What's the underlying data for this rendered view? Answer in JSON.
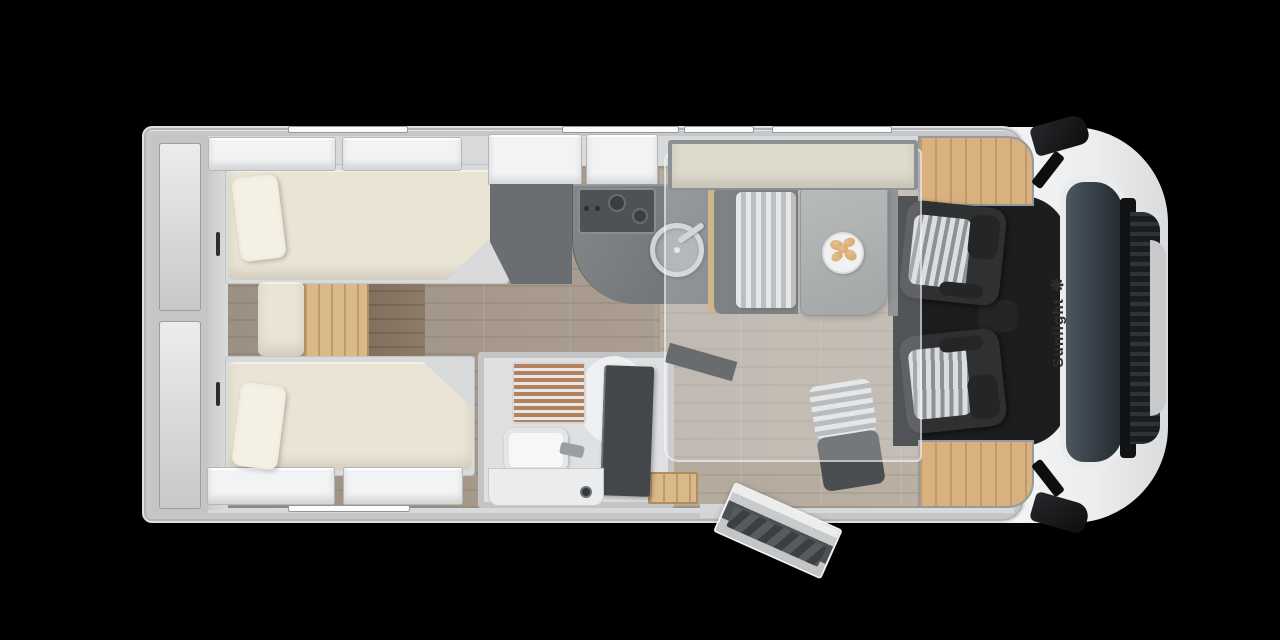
{
  "brand": {
    "name": "Sunlight",
    "logo_glyph": "❋"
  },
  "colors": {
    "background": "#000000",
    "shell": "#c6c7c9",
    "interior": "#d8d9da",
    "wood_floor_dark": "#82705e",
    "wood_floor_light": "#b9afa2",
    "wood_step": "#d9b88a",
    "wood_cab": "#d9b17e",
    "mattress": "#eae4d4",
    "pillow": "#f4f0e4",
    "locker": "#f2f3f4",
    "counter": "#6d7072",
    "cooktop": "#4f5254",
    "wardrobe": "#6b6e70",
    "shower_slat": "#b5805c",
    "bath_door": "#43474a",
    "bench_cushion_light": "#e6e7e8",
    "bench_cushion_dark": "#aeb1b3",
    "bench_base": "#595c5f",
    "table": "#8b8e8c",
    "plate": "#f5f5f5",
    "croissant": "#c98b3a",
    "seat_dark": "#2e3032",
    "cab_floor": "#1b1d1f",
    "windshield": "#39424a",
    "grille": "#1a1d20",
    "mirror": "#0c0d0e",
    "overlay_fill": "rgba(228,231,233,0.28)",
    "overlay_edge": "rgba(250,250,252,0.55)",
    "bed_panel": "#dedacc",
    "logo_color": "#2b2d2f"
  }
}
